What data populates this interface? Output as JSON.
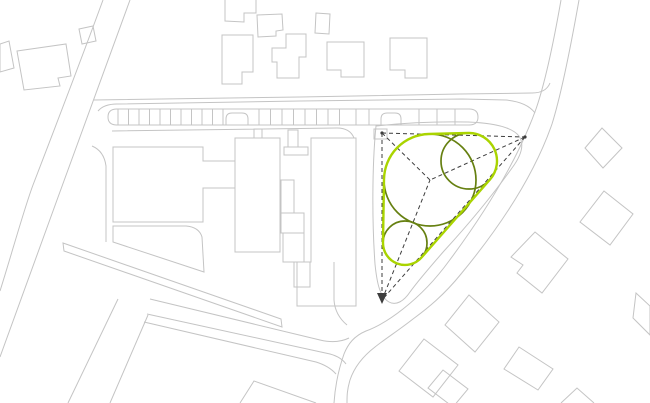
{
  "canvas": {
    "width": 650,
    "height": 403,
    "background": "#ffffff"
  },
  "palette": {
    "site_outline_gray": "#c4c4c4",
    "canopy_olive": "#668011",
    "hull_chartreuse": "#aad400",
    "dashed_dark": "#3d3d3d"
  },
  "legend_semantics": {
    "gray_lines": "existing site context: roads, parcels, buildings",
    "dashed_triangle": "site geometry / view lines converging on center",
    "olive_circles": "proposed tree canopies",
    "chartreuse_outline": "green space boundary (convex hull of canopies)"
  },
  "layers": [
    {
      "name": "roads-and-parcels",
      "stroke": "#c4c4c4",
      "width": 1,
      "fill": "none",
      "items": [
        {
          "name": "road-nw-west-edge",
          "type": "path",
          "d": "M103,0 C84,52 58,120 33,185 C24,209 12,253 0,291"
        },
        {
          "name": "road-nw-east-edge",
          "type": "path",
          "d": "M130,0 L57,200 L0,357"
        },
        {
          "name": "road-top-north-edge",
          "type": "path",
          "d": "M94,100 L300,97 L460,94 L532,93 Q546,93 550,83"
        },
        {
          "name": "road-top-south-edge",
          "type": "path",
          "d": "M98,111 Q104,104 117,104 L300,101 L462,99 L506,100 Q527,102 535,113"
        },
        {
          "name": "road-ne-west-edge",
          "type": "path",
          "d": "M561,0 C554,40 546,80 536,109 C517,162 484,214 449,261 C433,283 417,298 403,309 C389,320 377,327 366,331 C354,336 348,344 344,354 C338,371 335,388 334,403"
        },
        {
          "name": "road-ne-east-edge",
          "type": "path",
          "d": "M579,0 C571,45 562,92 552,124 C534,176 499,228 461,274 C444,295 428,308 413,319 C399,330 385,339 375,347 C362,357 354,368 350,380 C347,390 347,396 347,403"
        },
        {
          "name": "road-south-band-north-edge",
          "type": "path",
          "d": "M150,299 L320,340 Q337,344 349,338"
        },
        {
          "name": "strip-south-north-edge",
          "type": "path",
          "d": "M147,314 L330,354 Q341,357 346,364"
        },
        {
          "name": "strip-south-south-edge",
          "type": "path",
          "d": "M144,322 L316,362 Q329,366 336,374"
        },
        {
          "name": "parcel-edge-west",
          "type": "path",
          "d": "M118,299 L68,403"
        },
        {
          "name": "parcel-edge-east",
          "type": "path",
          "d": "M148,315 L110,403"
        },
        {
          "name": "corner-lot-south",
          "type": "path",
          "d": "M240,403 L254,381 L316,403"
        },
        {
          "name": "path-east-of-building",
          "type": "path",
          "d": "M334,262 L334,300 Q335,315 347,325"
        },
        {
          "name": "path-west-of-building",
          "type": "path",
          "d": "M92,146 Q104,151 106,166 L106,242"
        },
        {
          "name": "median-strip-mid",
          "type": "path",
          "d": "M63,243 L281,319 L282,327 L64,251 Z"
        },
        {
          "name": "site-edge-below-parking",
          "type": "path",
          "d": "M112,131 L337,128 Q350,128 354,138"
        },
        {
          "name": "green-zone-boundary",
          "type": "path",
          "d": "M376,126 Q420,121 468,122 C494,123 512,127 519,136 C525,145 521,156 512,168 C492,196 466,227 444,251 C430,267 418,281 410,292 C404,301 396,306 389,302 C380,297 377,284 375,264 C372,222 372,166 376,126 Z"
        },
        {
          "name": "parking-end-platform",
          "type": "path",
          "d": "M374,129 L387,129 L387,139 L374,139 Z"
        }
      ]
    },
    {
      "name": "parking-strip",
      "stroke": "#c4c4c4",
      "width": 1,
      "fill": "none",
      "items": [
        {
          "name": "parking-outline",
          "type": "path",
          "d": "M117,109 L469,109 Q478,109 478,117 Q478,125 469,125 L117,125 Q108,125 108,117 Q108,109 117,109 Z"
        },
        {
          "name": "parking-island-west",
          "type": "path",
          "d": "M226,125 L226,119 Q226,113 232,113 L242,113 Q248,113 248,119 L248,125"
        },
        {
          "name": "parking-island-east",
          "type": "path",
          "d": "M381,125 L381,119 Q381,113 387,113 L395,113 Q401,113 401,119 L401,125"
        },
        {
          "name": "parking-stall-ticks",
          "type": "ticks",
          "y1": 109,
          "y2": 125,
          "xs": [
            118,
            128.5,
            139,
            149.5,
            160,
            170.5,
            181,
            191.5,
            202,
            212.5,
            223,
            259,
            270.5,
            282,
            293.5,
            305,
            316.5,
            328,
            339.5,
            356,
            369,
            419,
            437,
            455
          ]
        }
      ]
    },
    {
      "name": "main-building-complex",
      "stroke": "#c4c4c4",
      "width": 1,
      "fill": "none",
      "items": [
        {
          "name": "building-west-block",
          "type": "path",
          "d": "M113,147 L203,147 L203,161 L235,161 L235,188 L203,188 L203,222 L113,222 Z"
        },
        {
          "name": "building-west-annex",
          "type": "path",
          "d": "M113,226 L186,226 Q199,227 202,237 L204,272 L113,242 Z"
        },
        {
          "name": "building-center-block",
          "type": "path",
          "d": "M235,138 L280,138 L280,252 L235,252 Z"
        },
        {
          "name": "building-center-shaft-upper",
          "type": "path",
          "d": "M281,180 L294,180 L294,213 L281,213 Z"
        },
        {
          "name": "building-center-shaft-bump",
          "type": "path",
          "d": "M281,213 L304,213 L304,233 L281,233 Z"
        },
        {
          "name": "building-center-shaft-lower",
          "type": "path",
          "d": "M283,233 L304,233 L304,262 L283,262 Z"
        },
        {
          "name": "building-center-foot",
          "type": "path",
          "d": "M294,262 L310,262 L310,287 L294,287 Z"
        },
        {
          "name": "building-east-slab",
          "type": "path",
          "d": "M311,138 L356,138 L356,306 L297,306 L297,262 L311,262 Z"
        },
        {
          "name": "building-entry-column",
          "type": "path",
          "d": "M288,130 L298,130 L298,147 L288,147 Z"
        },
        {
          "name": "building-entry-flare",
          "type": "path",
          "d": "M284,147 L308,147 L308,155 L284,155 Z"
        },
        {
          "name": "building-entry-stub",
          "type": "path",
          "d": "M254,129 L262,129 L262,138 L254,138 Z"
        }
      ]
    },
    {
      "name": "context-houses",
      "stroke": "#c4c4c4",
      "width": 1,
      "fill": "none",
      "items": [
        {
          "name": "house-west-edge-partial",
          "type": "path",
          "d": "M0,44 L9,41 L14,68 L0,72 Z"
        },
        {
          "name": "house-nw-large",
          "type": "path",
          "d": "M17,51 L66,44 L71,76 L58,78 L60,86 L24,90 Z"
        },
        {
          "name": "house-nw-small",
          "type": "path",
          "d": "M79,29 L93,26 L96,41 L82,44 Z"
        },
        {
          "name": "house-top-1",
          "type": "path",
          "d": "M225,0 L225,21 L244,22 L244,13 L256,13 L256,0"
        },
        {
          "name": "house-top-2",
          "type": "path",
          "d": "M257,15 L282,14 L283,30 L276,31 L276,36 L258,37 Z"
        },
        {
          "name": "house-top-3",
          "type": "path",
          "d": "M316,13 L330,14 L329,34 L315,33 Z"
        },
        {
          "name": "house-top-4",
          "type": "path",
          "d": "M222,35 L253,35 L253,72 L242,72 L242,84 L222,84 Z"
        },
        {
          "name": "house-top-5",
          "type": "path",
          "d": "M272,48 L286,48 L286,34 L306,34 L306,57 L299,57 L299,78 L277,78 L277,62 L272,62 Z"
        },
        {
          "name": "house-top-6",
          "type": "path",
          "d": "M327,42 L364,42 L364,77 L341,77 L341,70 L327,70 Z"
        },
        {
          "name": "house-top-7",
          "type": "path",
          "d": "M390,38 L427,38 L427,78 L405,78 L405,70 L390,70 Z"
        },
        {
          "name": "house-ne-1",
          "type": "path",
          "d": "M602,128 L622,148 L603,168 L585,148 Z"
        },
        {
          "name": "house-ne-2",
          "type": "path",
          "d": "M604,191 L633,214 L610,245 L580,222 Z"
        },
        {
          "name": "house-se-1",
          "type": "path",
          "d": "M535,232 L568,259 L542,293 L517,273 L523,265 L511,257 Z"
        },
        {
          "name": "house-east-edge-partial",
          "type": "path",
          "d": "M636,293 L650,306 L650,335 L633,318 Z"
        },
        {
          "name": "house-se-2",
          "type": "path",
          "d": "M519,347 L553,369 L538,390 L504,369 Z"
        },
        {
          "name": "house-se-3",
          "type": "path",
          "d": "M469,295 L499,322 L475,352 L445,325 Z"
        },
        {
          "name": "house-s-main",
          "type": "path",
          "d": "M424,339 L458,365 L433,397 L399,371 Z"
        },
        {
          "name": "house-s-wing",
          "type": "path",
          "d": "M443,370 L468,389 L453,407 L428,388 Z"
        },
        {
          "name": "house-bottom-edge-partial",
          "type": "path",
          "d": "M561,403 L577,388 L594,403"
        }
      ]
    },
    {
      "name": "concept-guides",
      "stroke": "#3d3d3d",
      "width": 1,
      "fill": "none",
      "dash": "4 3",
      "items": [
        {
          "name": "guide-triangle-top-edge",
          "type": "path",
          "d": "M382,133 L525,137"
        },
        {
          "name": "guide-triangle-east-edge",
          "type": "path",
          "d": "M525,137 L382,300"
        },
        {
          "name": "guide-triangle-west-edge",
          "type": "path",
          "d": "M382,133 L382,300"
        },
        {
          "name": "guide-spoke-nw",
          "type": "path",
          "d": "M382,133 L430,180"
        },
        {
          "name": "guide-spoke-ne",
          "type": "path",
          "d": "M525,137 L430,180"
        },
        {
          "name": "guide-spoke-s",
          "type": "path",
          "d": "M382,300 L430,180"
        }
      ]
    },
    {
      "name": "concept-markers",
      "stroke": "none",
      "width": 0,
      "fill": "#3d3d3d",
      "items": [
        {
          "name": "vertex-dot-nw",
          "type": "circle",
          "cx": 382,
          "cy": 133,
          "r": 1.6
        },
        {
          "name": "vertex-dot-ne",
          "type": "circle",
          "cx": 525,
          "cy": 137,
          "r": 1.6
        },
        {
          "name": "vertex-arrow-s",
          "type": "path",
          "d": "M382,304 L377,293 L387,293 Z"
        }
      ]
    },
    {
      "name": "tree-canopies",
      "stroke": "#668011",
      "width": 1.7,
      "fill": "none",
      "items": [
        {
          "name": "tree-canopy-large",
          "type": "circle",
          "cx": 430,
          "cy": 180,
          "r": 46
        },
        {
          "name": "tree-canopy-medium",
          "type": "circle",
          "cx": 469,
          "cy": 161,
          "r": 28
        },
        {
          "name": "tree-canopy-small",
          "type": "circle",
          "cx": 405,
          "cy": 243,
          "r": 22
        }
      ]
    },
    {
      "name": "green-hull",
      "stroke": "#aad400",
      "width": 2.4,
      "fill": "none",
      "items": [
        {
          "name": "green-space-hull-outline",
          "type": "path",
          "d": "M384,179.3 A46,46 0 0 1 428.8,134 L468.3,133 A28,28 0 0 1 490,179.5 L421.5,257.5 A22,22 0 0 1 383,242.7 Z"
        }
      ]
    }
  ]
}
